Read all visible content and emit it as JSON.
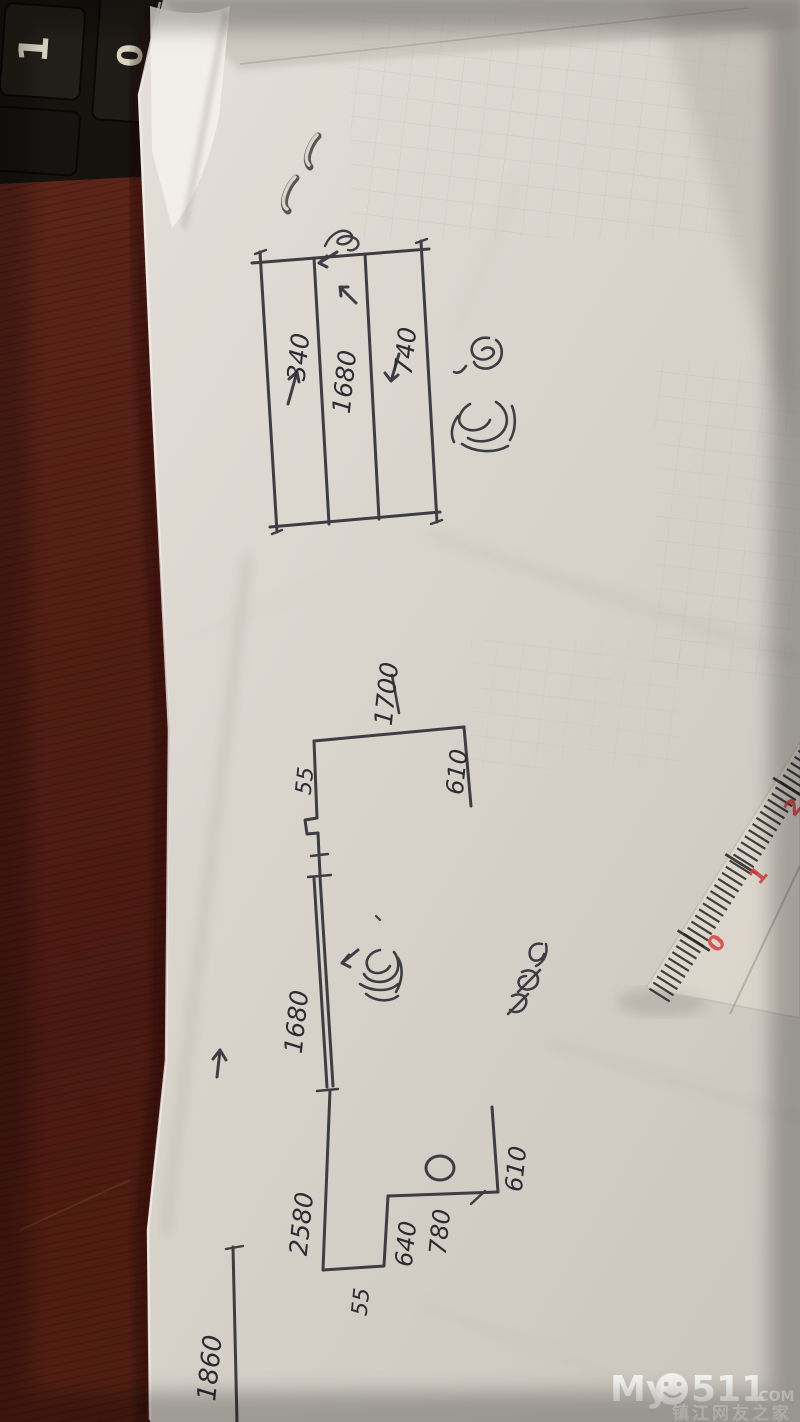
{
  "keyboard": {
    "keys": [
      {
        "label": "1"
      },
      {
        "label": "0"
      }
    ]
  },
  "paper": {
    "table_sketch": {
      "columns": [
        {
          "value": "340",
          "arrow": "up"
        },
        {
          "value": "1680",
          "arrow": "left"
        },
        {
          "value": "740",
          "arrow": "down"
        }
      ]
    },
    "plan_sketch": {
      "top_width": "1700",
      "right_upper_dim": "610",
      "upper_offset": "55",
      "window_length": "1680",
      "wall_length": "2580",
      "step_depth": "640",
      "step_width": "780",
      "right_lower_dim": "610",
      "lower_offset": "55"
    },
    "partial_dimension": "1860"
  },
  "ruler": {
    "tick_numbers": [
      "0",
      "1",
      "2"
    ],
    "number_color": "#d84040"
  },
  "watermark": {
    "prefix": "My",
    "number": "511",
    "tld": ".COM",
    "tagline": "镇江网友之家"
  }
}
